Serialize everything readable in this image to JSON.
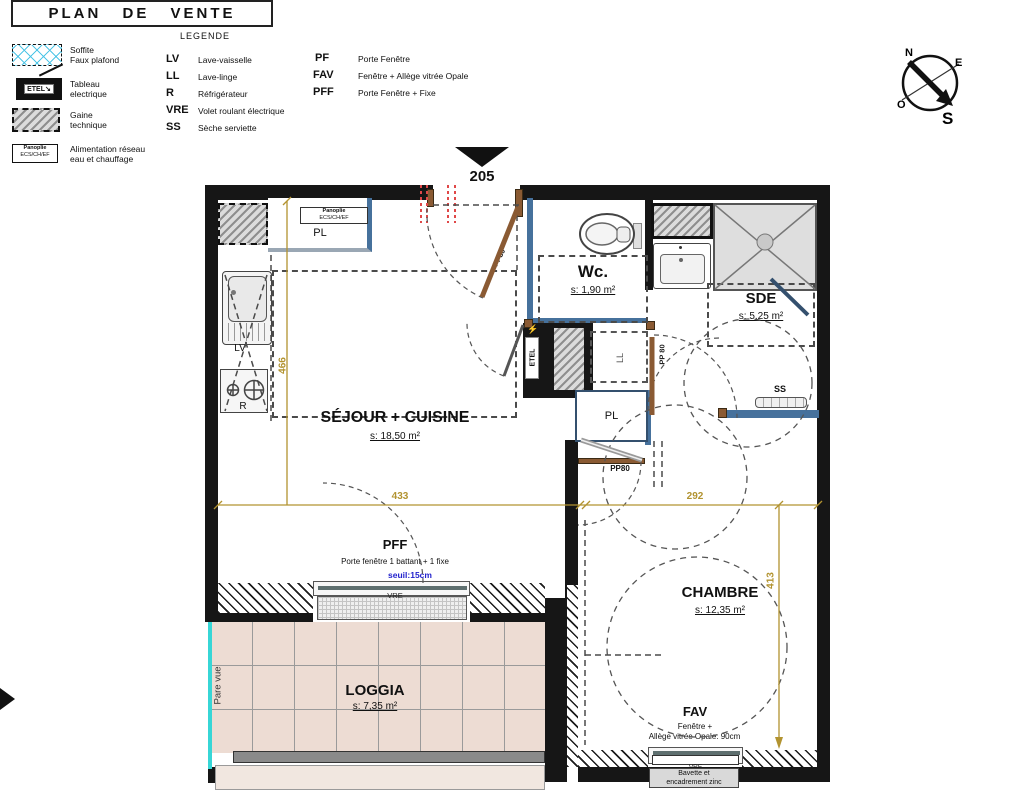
{
  "title": "PLAN DE VENTE",
  "unit_number": "205",
  "legend": {
    "heading": "LEGENDE",
    "soffite": {
      "line1": "Soffite",
      "line2": "Faux plafond"
    },
    "tableau": {
      "tag": "ETEL",
      "line1": "Tableau",
      "line2": "electrique"
    },
    "gaine": {
      "line1": "Gaine",
      "line2": "technique"
    },
    "panoplie": {
      "tag_line1": "Panoplie",
      "tag_line2": "ECS/CH/EF",
      "line1": "Alimentation réseau",
      "line2": "eau et chauffage"
    },
    "abbreviations": [
      {
        "abbr": "LV",
        "label": "Lave-vaisselle"
      },
      {
        "abbr": "LL",
        "label": "Lave-linge"
      },
      {
        "abbr": "R",
        "label": "Réfrigérateur"
      },
      {
        "abbr": "VRE",
        "label": "Volet roulant électrique"
      },
      {
        "abbr": "SS",
        "label": "Sèche serviette"
      }
    ],
    "openings": [
      {
        "abbr": "PF",
        "label": "Porte Fenêtre"
      },
      {
        "abbr": "FAV",
        "label": "Fenêtre + Allège vitrée Opale"
      },
      {
        "abbr": "PFF",
        "label": "Porte Fenêtre + Fixe"
      }
    ]
  },
  "compass": {
    "n": "N",
    "e": "E",
    "o": "O",
    "s": "S"
  },
  "rooms": {
    "sejour": {
      "name": "SÉJOUR + CUISINE",
      "area": "s: 18,50 m²"
    },
    "wc": {
      "name": "Wc.",
      "area": "s: 1,90 m²"
    },
    "sde": {
      "name": "SDE",
      "area": "s: 5,25 m²"
    },
    "chambre": {
      "name": "CHAMBRE",
      "area": "s: 12,35 m²"
    },
    "loggia": {
      "name": "LOGGIA",
      "area": "s: 7,35 m²"
    }
  },
  "fixtures": {
    "pl_top": "PL",
    "panoplie_line1": "Panoplie",
    "panoplie_line2": "ECS/CH/EF",
    "lv": "LV",
    "r": "R",
    "etel": "ETEL",
    "ll": "LL",
    "pl_mid": "PL",
    "ss": "SS",
    "pare_vue": "Pare vue"
  },
  "doors": {
    "entry": "PP80",
    "sde": "PP 80",
    "chambre": "PP80"
  },
  "dimensions": {
    "left": "466",
    "bottom_left": "433",
    "bottom_right": "292",
    "right": "413"
  },
  "pff": {
    "label": "PFF",
    "desc": "Porte fenêtre 1 battant + 1 fixe",
    "seuil": "seuil:15cm",
    "vre": "VRE"
  },
  "fav": {
    "label": "FAV",
    "desc_line1": "Fenêtre +",
    "desc_line2": "Allège vitrée Opale: 90cm",
    "vre": "VRE",
    "bavette_line1": "Bavette et",
    "bavette_line2": "encadrement zinc"
  },
  "colors": {
    "dimension": "#b29330",
    "partition": "#46719c",
    "door": "#8a5a33",
    "cyan": "#37d6d6",
    "seuil": "#2121cc",
    "red_mark": "#e04848"
  }
}
